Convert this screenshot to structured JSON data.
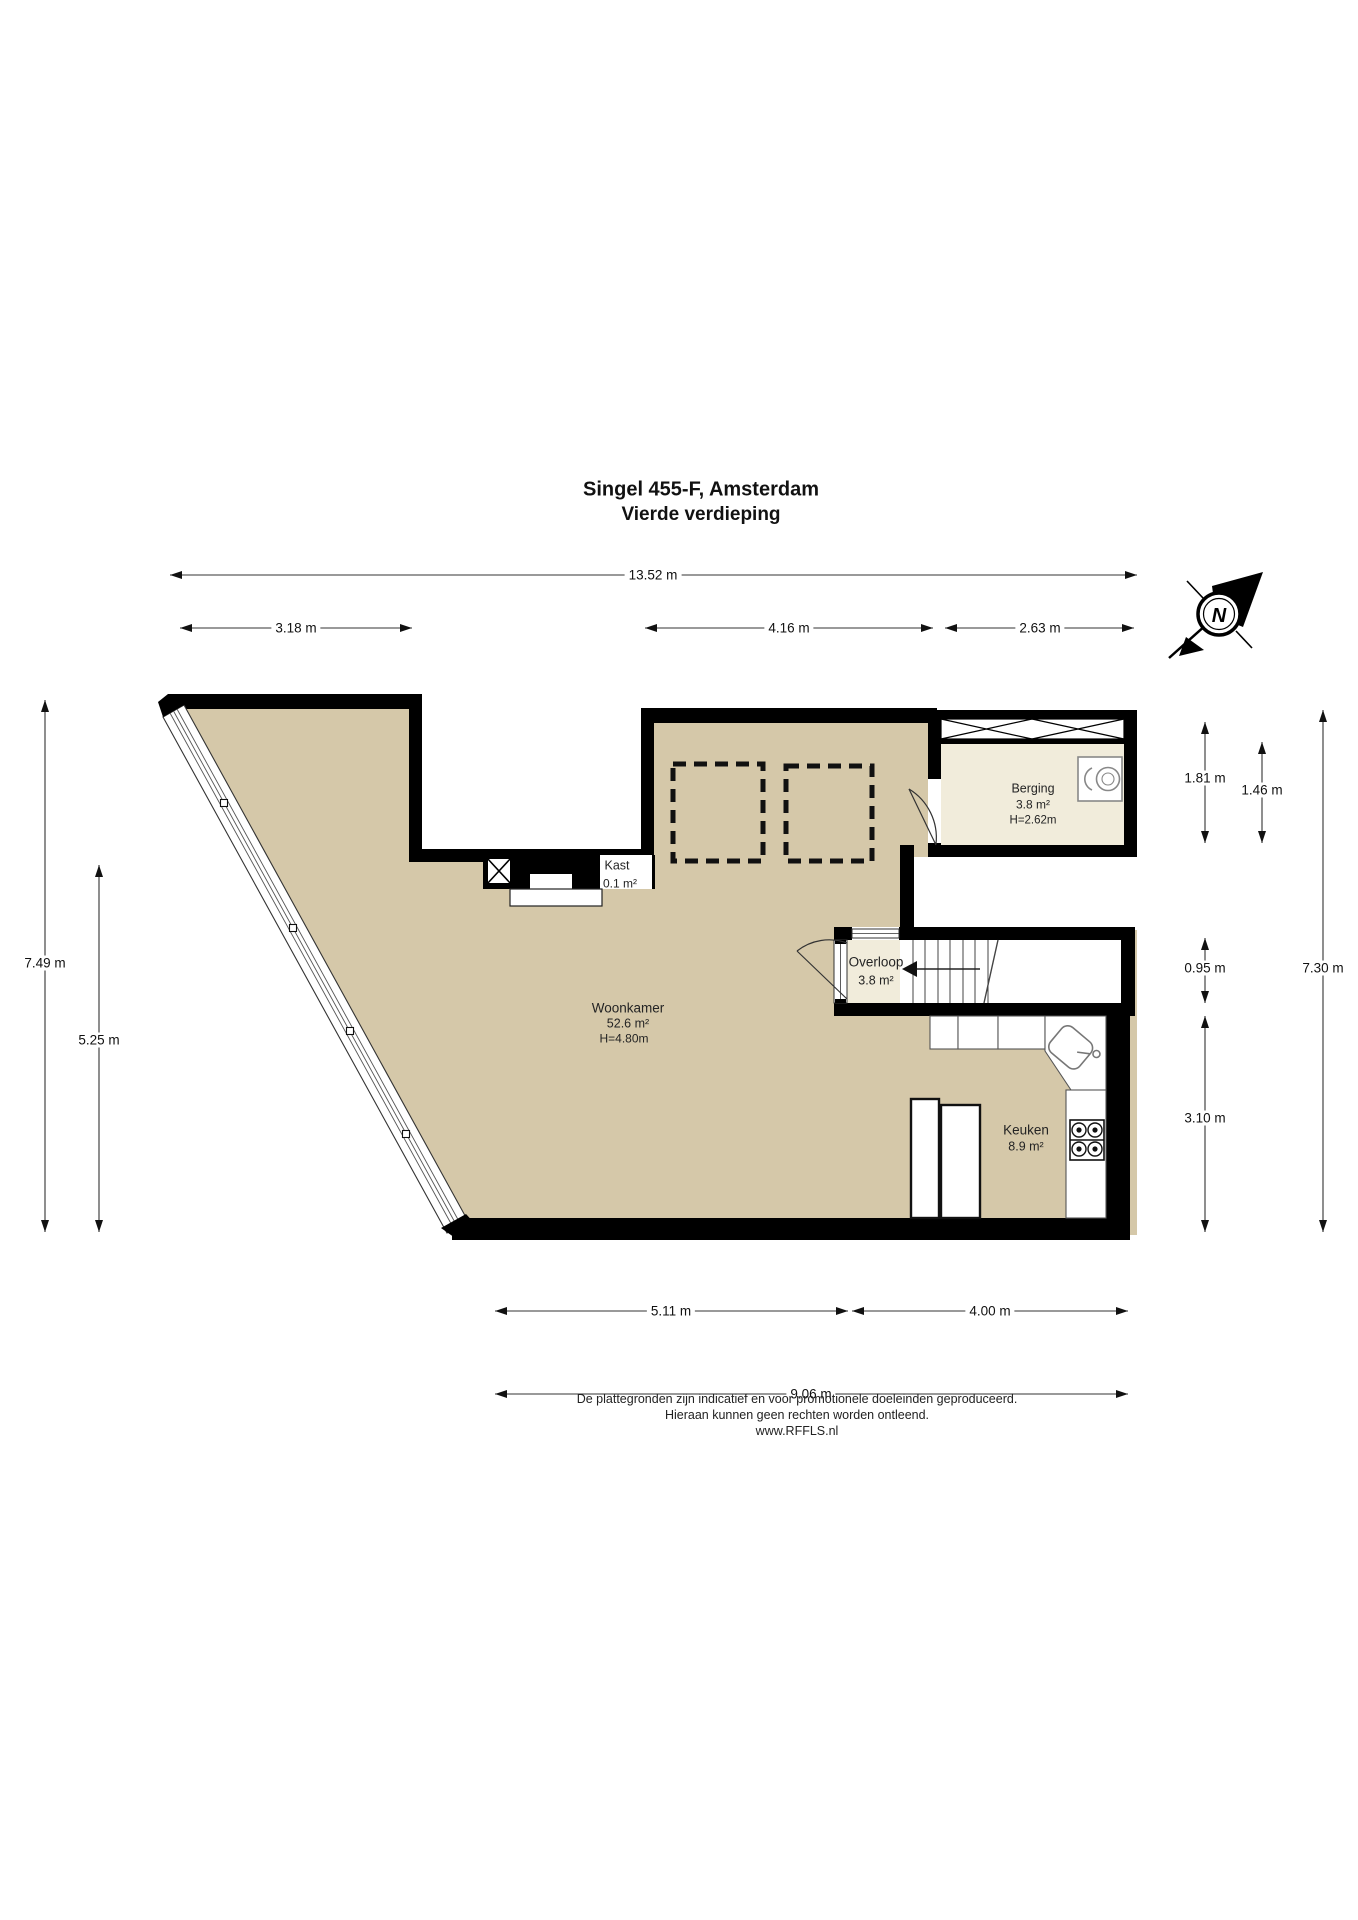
{
  "title": {
    "line1": "Singel 455-F, Amsterdam",
    "line2": "Vierde verdieping"
  },
  "compass": {
    "north_label": "N"
  },
  "rooms": {
    "woonkamer": {
      "name": "Woonkamer",
      "area": "52.6 m²",
      "ceiling": "H=4.80m"
    },
    "keuken": {
      "name": "Keuken",
      "area": "8.9 m²"
    },
    "berging": {
      "name": "Berging",
      "area": "3.8 m²",
      "ceiling": "H=2.62m"
    },
    "overloop": {
      "name": "Overloop",
      "area": "3.8 m²"
    },
    "kast": {
      "name": "Kast",
      "area": "0.1 m²"
    }
  },
  "dimensions": {
    "top_total": "13.52 m",
    "top_left": "3.18 m",
    "top_mid": "4.16 m",
    "top_right": "2.63 m",
    "left_outer": "7.49 m",
    "left_inner": "5.25 m",
    "right_berging_outer": "1.81 m",
    "right_berging_inner": "1.46 m",
    "right_overloop": "0.95 m",
    "right_keuken": "3.10 m",
    "right_total": "7.30 m",
    "bottom_left": "5.11 m",
    "bottom_right": "4.00 m",
    "bottom_total": "9.06 m"
  },
  "footer": {
    "line1": "De plattegronden zijn indicatief en voor promotionele doeleinden geproduceerd.",
    "line2": "Hieraan kunnen geen rechten worden ontleend.",
    "line3": "www.RFFLS.nl"
  },
  "colors": {
    "floor_main": "#d5c8a9",
    "floor_light": "#f1ecdb",
    "wall": "#000000",
    "dim_line": "#333333"
  }
}
